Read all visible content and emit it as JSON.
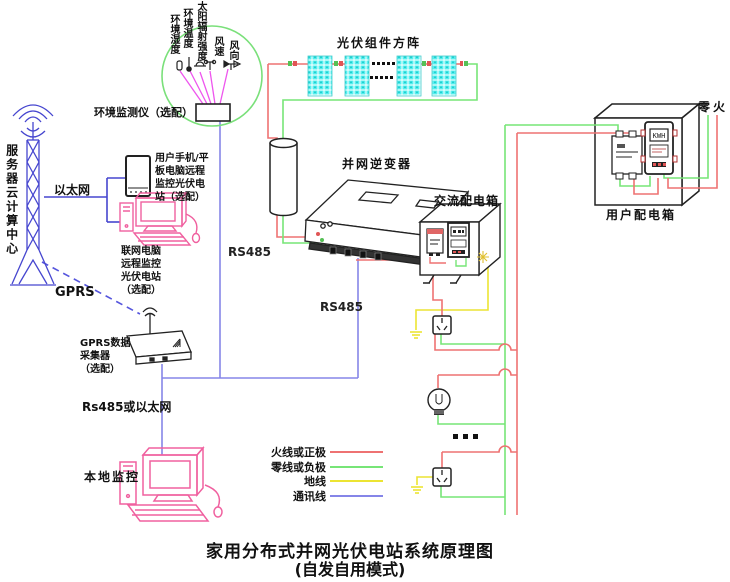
{
  "title": {
    "line1": "家用分布式并网光伏电站系统原理图",
    "line2": "(自发自用模式)"
  },
  "env_monitor": {
    "sensors": [
      "环境湿度",
      "环境温度",
      "太阳辐射强度",
      "风速",
      "风向"
    ],
    "label": "环境监测仪（选配）"
  },
  "cloud": {
    "server_label": "服务器云计算中心",
    "ethernet_label": "以太网",
    "gprs_label": "GPRS",
    "phone_label": "用户手机/平\n板电脑远程\n监控光伏电\n站（选配）",
    "remote_pc_label": "联网电脑\n远程监控\n光伏电站\n（选配）",
    "gprs_collector_label": "GPRS数据\n采集器\n（选配）"
  },
  "monitoring": {
    "rs485_env": "RS485",
    "rs485_inverter": "RS485",
    "rs485_or_ethernet": "Rs485或以太网",
    "local_monitor": "本地监控"
  },
  "pv_system": {
    "array_label": "光伏组件方阵",
    "inverter_label": "并网逆变器",
    "ac_box_label": "交流配电箱",
    "user_box_label": "用户配电箱",
    "neutral_live_label": "零火",
    "meter_display": "KWH"
  },
  "legend": {
    "items": [
      {
        "label": "火线或正极",
        "color": "#ee7272"
      },
      {
        "label": "零线或负极",
        "color": "#77e577"
      },
      {
        "label": "地线",
        "color": "#ece433"
      },
      {
        "label": "通讯线",
        "color": "#8585e8"
      }
    ]
  },
  "colors": {
    "live_or_positive": "#ee7272",
    "neutral_or_negative": "#77e577",
    "ground": "#ece433",
    "communication": "#8585e8",
    "network_blue": "#4646cf",
    "sensor_magenta": "#ee55ee",
    "computer_pink": "#f0609f",
    "panel_cyan": "#55efef",
    "circle_green": "#7ae07a"
  }
}
